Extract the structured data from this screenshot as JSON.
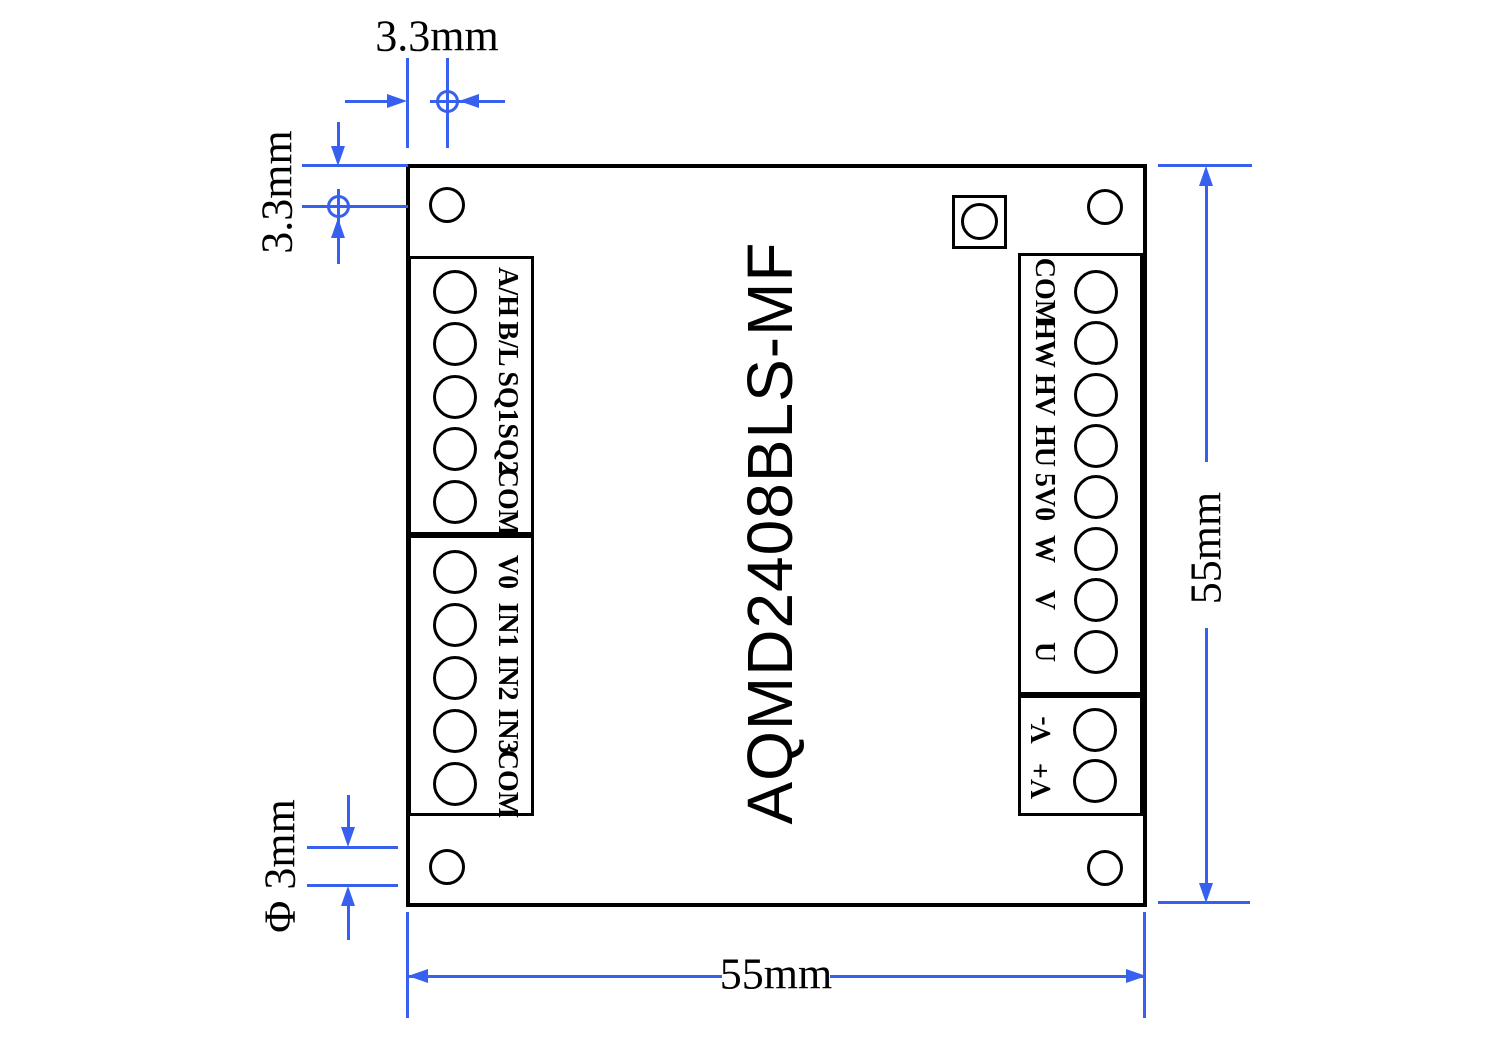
{
  "title": "AQMD2408BLS-MF",
  "blocks": {
    "left1": {
      "labels": [
        "A/H",
        "B/L",
        "SQ1",
        "SQ2",
        "COM"
      ]
    },
    "left2": {
      "labels": [
        "V0",
        "IN1",
        "IN2",
        "IN3",
        "COM"
      ]
    },
    "right1": {
      "labels": [
        "COM",
        "HW",
        "HV",
        "HU",
        "5V0",
        "W",
        "V",
        "U"
      ]
    },
    "right2": {
      "labels": [
        "V-",
        "V+"
      ]
    }
  },
  "dimensions": {
    "hole_offset_x": "3.3mm",
    "hole_offset_y": "3.3mm",
    "hole_diameter": "Φ 3mm",
    "board_width": "55mm",
    "board_height": "55mm"
  },
  "colors": {
    "dimension_blue": "#3760ee",
    "outline_black": "#000000"
  }
}
